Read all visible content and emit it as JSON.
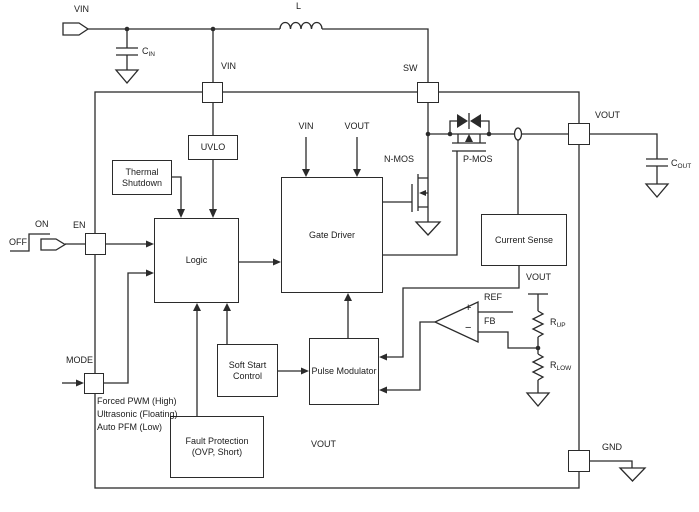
{
  "colors": {
    "line": "#2b2b2b",
    "text": "#1c1c1c",
    "background": "#ffffff"
  },
  "pins": {
    "vin": "VIN",
    "sw": "SW",
    "en": "EN",
    "mode": "MODE",
    "vout": "VOUT",
    "gnd": "GND"
  },
  "external": {
    "vin_tag": "VIN",
    "inductor": "L",
    "cin": {
      "main": "C",
      "sub": "IN"
    },
    "cout": {
      "main": "C",
      "sub": "OUT"
    },
    "on": "ON",
    "off": "OFF"
  },
  "blocks": {
    "uvlo": {
      "label": "UVLO"
    },
    "thermal_shutdown": {
      "line1": "Thermal",
      "line2": "Shutdown"
    },
    "logic": {
      "label": "Logic"
    },
    "gate_driver": {
      "label": "Gate Driver"
    },
    "current_sense": {
      "label": "Current Sense"
    },
    "soft_start": {
      "line1": "Soft Start",
      "line2": "Control"
    },
    "pulse_modulator": {
      "label": "Pulse Modulator"
    },
    "fault_protection": {
      "line1": "Fault Protection",
      "line2": "(OVP, Short)"
    }
  },
  "internal": {
    "nmos": "N-MOS",
    "pmos": "P-MOS",
    "gate_driver_vin": "VIN",
    "gate_driver_vout": "VOUT",
    "ref": "REF",
    "fb": "FB",
    "plus": "+",
    "minus": "−",
    "divider_vout": "VOUT",
    "rup": {
      "main": "R",
      "sub": "UP"
    },
    "rlow": {
      "main": "R",
      "sub": "LOW"
    },
    "fault_vout": "VOUT",
    "mode_options": [
      "Forced PWM (High)",
      "Ultrasonic (Floating)",
      "Auto PFM (Low)"
    ]
  }
}
